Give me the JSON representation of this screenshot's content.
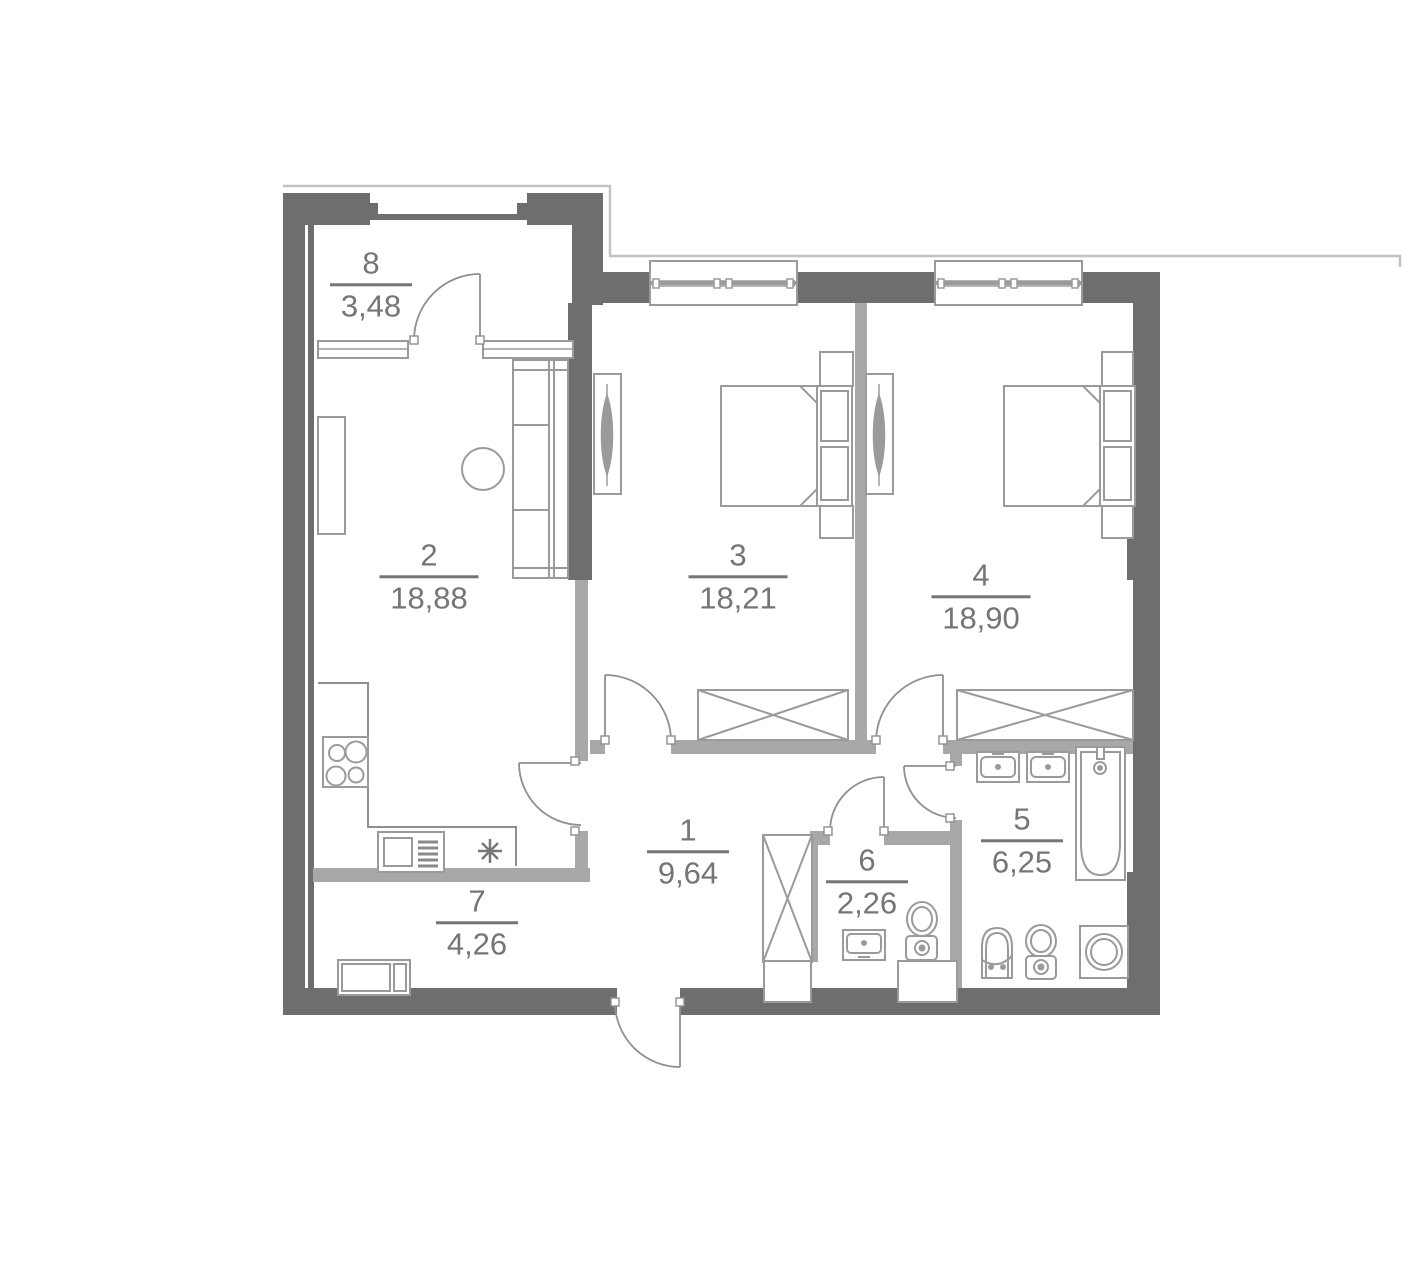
{
  "plan": {
    "rooms": [
      {
        "number": "1",
        "area": "9,64"
      },
      {
        "number": "2",
        "area": "18,88"
      },
      {
        "number": "3",
        "area": "18,21"
      },
      {
        "number": "4",
        "area": "18,90"
      },
      {
        "number": "5",
        "area": "6,25"
      },
      {
        "number": "6",
        "area": "2,26"
      },
      {
        "number": "7",
        "area": "4,26"
      },
      {
        "number": "8",
        "area": "3,48"
      }
    ],
    "colors": {
      "wall": "#6e6e6e",
      "partition": "#a8a8a8",
      "furniture_line": "#9a9a9a",
      "door_line": "#8f8f8f",
      "outline": "#c2c2c2",
      "label_text": "#757575",
      "background": "#ffffff"
    }
  }
}
